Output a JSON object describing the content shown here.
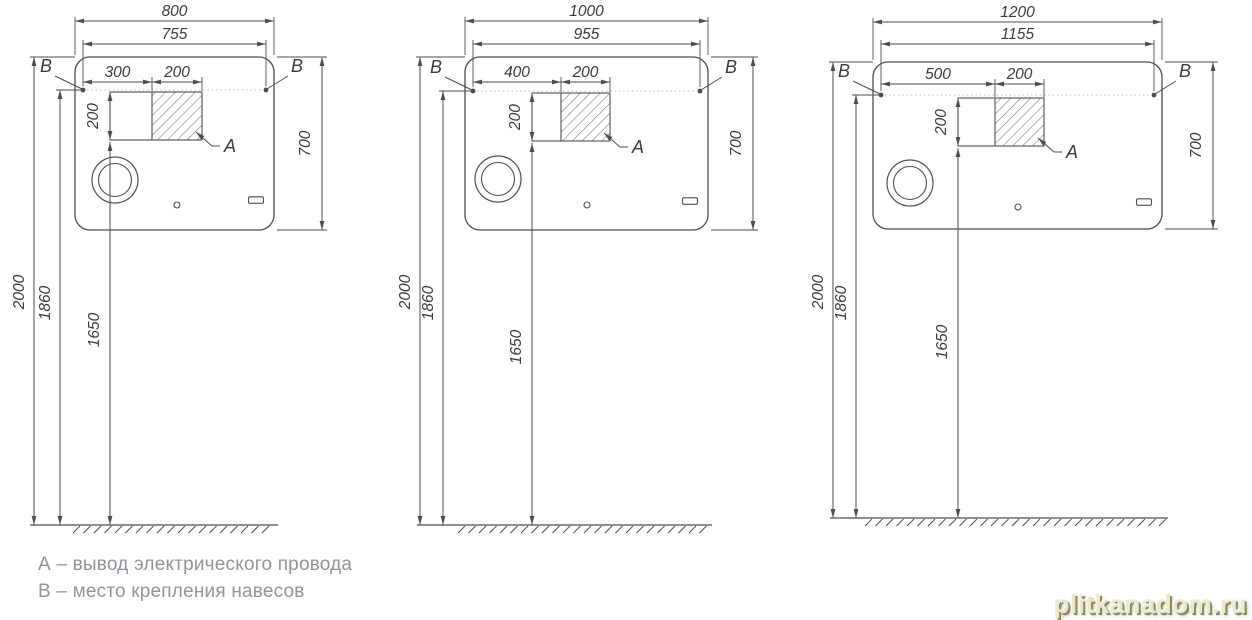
{
  "legend": {
    "item_a": "А – вывод электрического провода",
    "item_b": "В – место крепления навесов"
  },
  "watermark": {
    "text": "plitkanadom.ru"
  },
  "colors": {
    "line": "#4e4e4e",
    "hatch": "#5a5a5a",
    "text": "#3b3b3b",
    "dotted_line": "#bcbcbc",
    "legend_text": "#8f959c",
    "watermark_fill": "#ece8cd"
  },
  "diagrams": [
    {
      "id": "mirror-800",
      "labels": {
        "a": "A",
        "b": "B"
      },
      "dimensions_mm": {
        "overall_width": "800",
        "mounting_span": "755",
        "outlet_offset": "300",
        "outlet_width": "200",
        "outlet_height": "200",
        "mirror_height": "700",
        "overall_top_height": "2000",
        "mounting_height": "1860",
        "outlet_bottom_height": "1650"
      }
    },
    {
      "id": "mirror-1000",
      "labels": {
        "a": "A",
        "b": "B"
      },
      "dimensions_mm": {
        "overall_width": "1000",
        "mounting_span": "955",
        "outlet_offset": "400",
        "outlet_width": "200",
        "outlet_height": "200",
        "mirror_height": "700",
        "overall_top_height": "2000",
        "mounting_height": "1860",
        "outlet_bottom_height": "1650"
      }
    },
    {
      "id": "mirror-1200",
      "labels": {
        "a": "A",
        "b": "B"
      },
      "dimensions_mm": {
        "overall_width": "1200",
        "mounting_span": "1155",
        "outlet_offset": "500",
        "outlet_width": "200",
        "outlet_height": "200",
        "mirror_height": "700",
        "overall_top_height": "2000",
        "mounting_height": "1860",
        "outlet_bottom_height": "1650"
      }
    }
  ]
}
